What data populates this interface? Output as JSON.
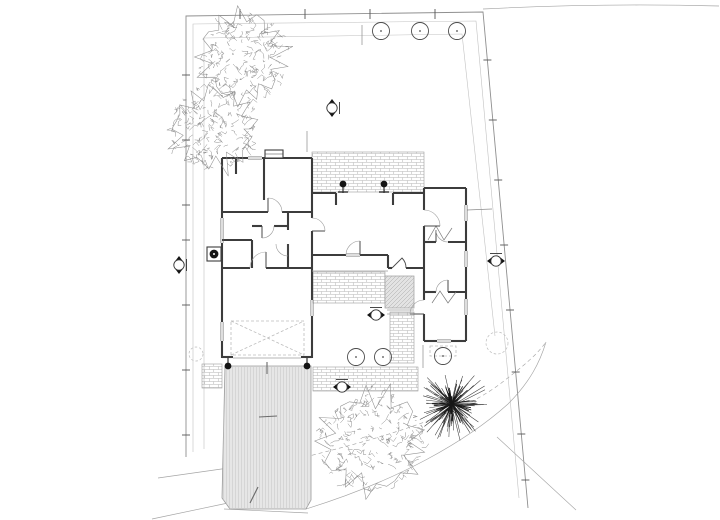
{
  "document": {
    "kind": "architectural-site-plan",
    "visible_text": []
  },
  "canvas": {
    "width": 720,
    "height": 520,
    "background": "#ffffff"
  },
  "palette": {
    "wall": "#3c3c3c",
    "window": "#5a5a5a",
    "boundary": "#8f8f8f",
    "faint": "#c2c2c2",
    "mid": "#a5a5a5",
    "tick": "#555555",
    "arc": "#9a9a9a",
    "leaf": "#4a4a4a",
    "black": "#141414",
    "tree": "#8e8e8e",
    "yucca": "#3a3a3a",
    "yucca_dark": "#161616",
    "drive_fill": "#e6e6e6",
    "drive_edge": "#9a9a9a",
    "hatch_edge": "#9c9c9c",
    "dash": "#bcbcbc",
    "thin": "#8c8c8c"
  },
  "site": {
    "boundary_outer": [
      [
        186,
        457
      ],
      [
        186,
        16
      ],
      [
        483,
        12
      ],
      [
        528,
        508
      ]
    ],
    "inner_lines": [
      {
        "pts": [
          [
            193,
            452
          ],
          [
            193,
            24
          ],
          [
            476,
            21
          ],
          [
            519,
            498
          ]
        ]
      },
      {
        "pts": [
          [
            204,
            449
          ],
          [
            204,
            38
          ],
          [
            462,
            34
          ],
          [
            495,
            336
          ]
        ]
      }
    ],
    "road_paths": [
      {
        "d": "M483,9 C560,5 640,4 719,6",
        "dash": ""
      },
      {
        "d": "M152,519 L228,503",
        "dash": ""
      },
      {
        "d": "M158,478 L306,457",
        "dash": ""
      },
      {
        "d": "M228,504 L306,509 C400,480 468,440 508,404 C530,382 540,362 546,342",
        "dash": ""
      },
      {
        "d": "M305,457 C390,436 460,414 500,384 C522,367 536,356 546,342",
        "dash": "4,3"
      },
      {
        "d": "M497,437 L576,510",
        "dash": ""
      },
      {
        "d": "M224,509 L308,513",
        "dash": ""
      }
    ],
    "guide_lines": [
      [
        362,
        25,
        362,
        45
      ],
      [
        307,
        131,
        307,
        152
      ],
      [
        467,
        210,
        492,
        209
      ],
      [
        423,
        345,
        423,
        368
      ]
    ],
    "ticks": [
      [
        182,
        75,
        190,
        75
      ],
      [
        182,
        140,
        190,
        140
      ],
      [
        182,
        205,
        190,
        205
      ],
      [
        182,
        240,
        190,
        240
      ],
      [
        182,
        305,
        190,
        305
      ],
      [
        182,
        370,
        190,
        370
      ],
      [
        182,
        435,
        190,
        435
      ],
      [
        240,
        9,
        240,
        19
      ],
      [
        305,
        9,
        305,
        19
      ],
      [
        370,
        9,
        370,
        19
      ],
      [
        435,
        9,
        435,
        19
      ],
      [
        483.4,
        60,
        491.4,
        60
      ],
      [
        488.8,
        120,
        496.8,
        120
      ],
      [
        494.2,
        180,
        502.2,
        180
      ],
      [
        500.1,
        245,
        508.1,
        245
      ],
      [
        506,
        310,
        514,
        310
      ],
      [
        511.7,
        372,
        519.7,
        372
      ],
      [
        517.3,
        434,
        525.3,
        434
      ],
      [
        521.4,
        480,
        529.4,
        480
      ]
    ]
  },
  "house": {
    "walls": [
      [
        222,
        158,
        248,
        158
      ],
      [
        262,
        158,
        312,
        158
      ],
      [
        222,
        158,
        222,
        218
      ],
      [
        222,
        243,
        222,
        268
      ],
      [
        222,
        268,
        222,
        322
      ],
      [
        222,
        341,
        222,
        358
      ],
      [
        312,
        158,
        312,
        218
      ],
      [
        312,
        231,
        312,
        255
      ],
      [
        312,
        255,
        312,
        300
      ],
      [
        312,
        316,
        312,
        358
      ],
      [
        312,
        193,
        336,
        193
      ],
      [
        393,
        193,
        424,
        193
      ],
      [
        424,
        188,
        424,
        193
      ],
      [
        424,
        188,
        466,
        188
      ],
      [
        466,
        188,
        466,
        205
      ],
      [
        466,
        221,
        466,
        251
      ],
      [
        466,
        267,
        466,
        299
      ],
      [
        466,
        315,
        466,
        341
      ],
      [
        466,
        341,
        451,
        341
      ],
      [
        437,
        341,
        424,
        341
      ],
      [
        424,
        341,
        424,
        314
      ],
      [
        424,
        300,
        424,
        268
      ],
      [
        424,
        268,
        424,
        226
      ],
      [
        424,
        210,
        424,
        193
      ],
      [
        312,
        255,
        346,
        255
      ],
      [
        360,
        255,
        388,
        255
      ],
      [
        388,
        255,
        388,
        268
      ],
      [
        388,
        268,
        392,
        268
      ],
      [
        406,
        268,
        424,
        268
      ],
      [
        222,
        268,
        250,
        268
      ],
      [
        266,
        268,
        312,
        268
      ],
      [
        222,
        357,
        233,
        357
      ],
      [
        301,
        357,
        312,
        357
      ],
      [
        264,
        158,
        264,
        200
      ],
      [
        222,
        212,
        268,
        212
      ],
      [
        282,
        212,
        312,
        212
      ],
      [
        222,
        240,
        252,
        240
      ],
      [
        252,
        240,
        252,
        268
      ],
      [
        252,
        226,
        262,
        226
      ],
      [
        274,
        226,
        288,
        226
      ],
      [
        288,
        212,
        288,
        230
      ],
      [
        288,
        244,
        288,
        268
      ],
      [
        236,
        158,
        236,
        174
      ],
      [
        424,
        242,
        436,
        242
      ],
      [
        448,
        242,
        466,
        242
      ],
      [
        424,
        292,
        436,
        292
      ],
      [
        448,
        292,
        466,
        292
      ],
      [
        336,
        193,
        336,
        205
      ],
      [
        393,
        193,
        393,
        205
      ]
    ],
    "windows": [
      [
        248,
        158,
        262,
        158
      ],
      [
        222,
        218,
        222,
        243
      ],
      [
        222,
        322,
        222,
        341
      ],
      [
        466,
        205,
        466,
        221
      ],
      [
        466,
        251,
        466,
        267
      ],
      [
        466,
        299,
        466,
        315
      ],
      [
        346,
        255,
        360,
        255
      ],
      [
        437,
        341,
        451,
        341
      ],
      [
        312,
        300,
        312,
        316
      ]
    ],
    "doors": [
      [
        268,
        212,
        14,
        270,
        360
      ],
      [
        312,
        231,
        13,
        0,
        -90
      ],
      [
        262,
        226,
        12,
        90,
        0
      ],
      [
        266,
        268,
        16,
        270,
        180
      ],
      [
        360,
        255,
        14,
        270,
        180
      ],
      [
        424,
        226,
        16,
        0,
        -90
      ],
      [
        436,
        242,
        12,
        270,
        0
      ],
      [
        448,
        292,
        12,
        270,
        180
      ],
      [
        424,
        314,
        14,
        180,
        270
      ],
      [
        288,
        244,
        12,
        90,
        180
      ]
    ],
    "entry_door_path": "M392,268 L402,258 A14 14 0 0 1 406,268",
    "thin_lines": [
      [
        387,
        310,
        414,
        310
      ],
      [
        387,
        314,
        414,
        314
      ],
      [
        233,
        358,
        301,
        358
      ],
      [
        312,
        271,
        388,
        271
      ]
    ],
    "zigzags": [
      [
        428,
        240,
        436,
        226,
        444,
        240,
        452,
        228
      ],
      [
        432,
        303,
        440,
        291,
        448,
        303,
        456,
        292
      ]
    ],
    "chimney": {
      "x": 265,
      "y": 150,
      "w": 18,
      "h": 8
    },
    "ac_unit": {
      "x": 207,
      "y": 247,
      "w": 14,
      "h": 14
    }
  },
  "landscape": {
    "patios_brick": [
      {
        "x": 312,
        "y": 152,
        "w": 112,
        "h": 40
      },
      {
        "x": 313,
        "y": 272,
        "w": 72,
        "h": 31
      },
      {
        "x": 390,
        "y": 312,
        "w": 24,
        "h": 51
      },
      {
        "x": 313,
        "y": 367,
        "w": 105,
        "h": 24
      },
      {
        "x": 202,
        "y": 364,
        "w": 20,
        "h": 24
      }
    ],
    "deck": {
      "x": 385,
      "y": 276,
      "w": 29,
      "h": 32
    },
    "driveway": {
      "pts": [
        [
          225,
          366
        ],
        [
          311,
          366
        ],
        [
          311,
          500
        ],
        [
          306,
          509
        ],
        [
          230,
          509
        ],
        [
          222,
          498
        ]
      ],
      "marks": [
        [
          259,
          417,
          277,
          416
        ],
        [
          250,
          503,
          258,
          487
        ],
        [
          267,
          362,
          267,
          374
        ]
      ]
    },
    "carport": {
      "x": 231,
      "y": 321,
      "w": 73,
      "h": 34
    },
    "porch_dashed": {
      "x": 430,
      "y": 346,
      "w": 26,
      "h": 10
    },
    "trees": [
      {
        "cx": 243,
        "cy": 57,
        "r": 48,
        "seed": 11
      },
      {
        "cx": 213,
        "cy": 129,
        "r": 46,
        "seed": 23
      },
      {
        "cx": 372,
        "cy": 441,
        "r": 57,
        "seed": 37
      }
    ],
    "yucca": {
      "cx": 452,
      "cy": 404,
      "r": 38,
      "seed": 51
    },
    "shrubs": [
      {
        "cx": 381,
        "cy": 31
      },
      {
        "cx": 420,
        "cy": 31
      },
      {
        "cx": 457,
        "cy": 31
      },
      {
        "cx": 356,
        "cy": 357
      },
      {
        "cx": 383,
        "cy": 357
      },
      {
        "cx": 443,
        "cy": 356
      }
    ],
    "shrub_radius": 8.5,
    "dashed_circles": [
      {
        "cx": 497,
        "cy": 343,
        "r": 11
      },
      {
        "cx": 196,
        "cy": 354,
        "r": 7
      }
    ]
  },
  "symbols": {
    "spot_markers": [
      {
        "x": 332,
        "y": 108,
        "rot": 90
      },
      {
        "x": 179,
        "y": 265,
        "rot": 90
      },
      {
        "x": 496,
        "y": 261,
        "rot": 0
      },
      {
        "x": 376,
        "y": 315,
        "rot": 0
      },
      {
        "x": 342,
        "y": 387,
        "rot": 0
      }
    ],
    "columns": [
      {
        "x": 343,
        "y": 184
      },
      {
        "x": 384,
        "y": 184
      }
    ],
    "posts": [
      {
        "x": 228,
        "y": 366
      },
      {
        "x": 307,
        "y": 366
      }
    ]
  }
}
